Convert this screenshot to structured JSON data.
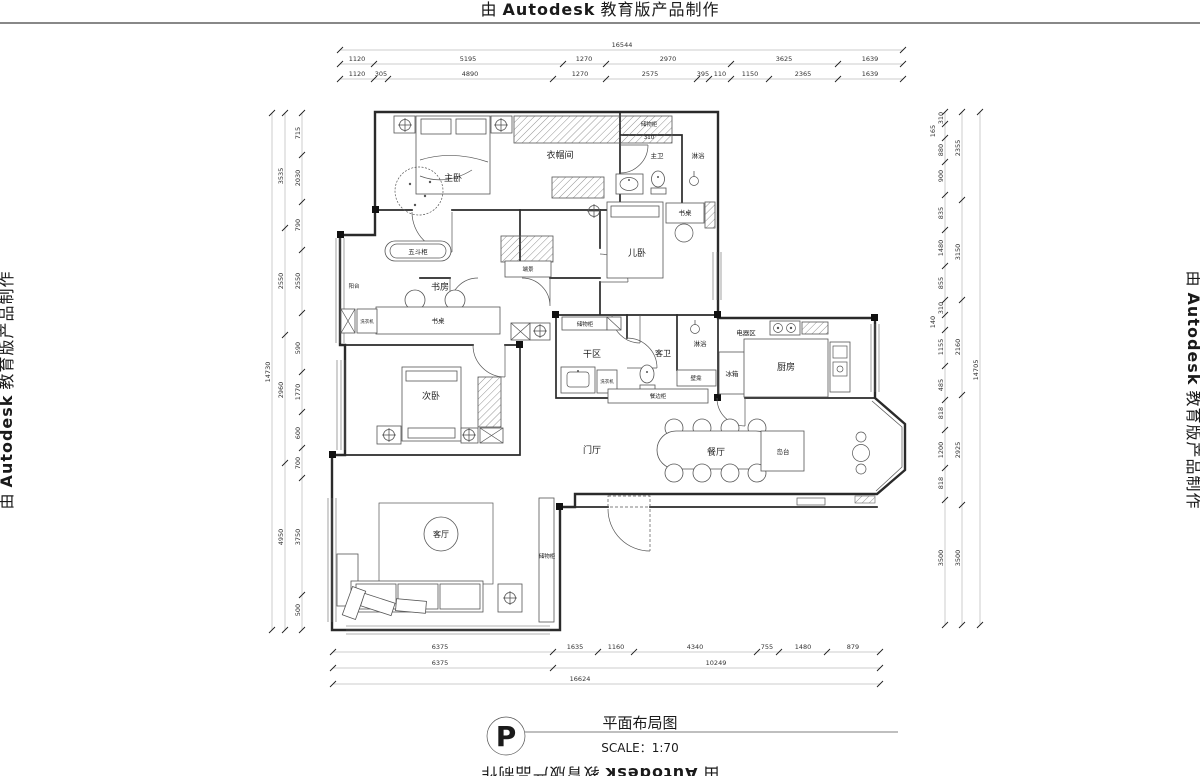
{
  "watermark": {
    "prefix": "由",
    "brand": "Autodesk",
    "suffix": "教育版产品制作"
  },
  "title_block": {
    "north_symbol": "P",
    "title": "平面布局图",
    "scale": "SCALE：1:70"
  },
  "rooms": {
    "master_bedroom": "主卧",
    "cloakroom": "衣帽间",
    "closet_top": "储物柜",
    "closet_top_dim": "310",
    "master_bath": "主卫",
    "master_shower": "淋浴",
    "kids_desk": "书桌",
    "kids_bedroom": "儿卧",
    "chest": "五斗柜",
    "balcony": "阳台",
    "study": "书房",
    "study_desk": "书桌",
    "washer_balcony": "洗衣机",
    "end_feature": "端景",
    "second_bedroom": "次卧",
    "dry_storage": "储物柜",
    "dry_area": "干区",
    "washer": "洗衣机",
    "guest_bath": "客卫",
    "guest_shower": "淋浴",
    "niche": "壁龛",
    "sideboard": "餐边柜",
    "appliance_area": "电器区",
    "fridge": "冰箱",
    "kitchen": "厨房",
    "foyer": "门厅",
    "dining": "餐厅",
    "island": "岛台",
    "living": "客厅",
    "living_storage": "储物柜"
  },
  "dims": {
    "top": {
      "total": "16544",
      "row2": [
        "1120",
        "5195",
        "1270",
        "2970",
        "3625",
        "1639"
      ],
      "row3": [
        "1120",
        "305",
        "4890",
        "1270",
        "2575",
        "395",
        "110",
        "1150",
        "2365",
        "1639"
      ]
    },
    "bottom": {
      "row1": [
        "6375",
        "1635",
        "1160",
        "4340",
        "755",
        "1480",
        "879"
      ],
      "row2": [
        "6375",
        "10249"
      ],
      "total": "16624"
    },
    "left": {
      "outer": "14730",
      "colA": [
        "3535",
        "2550",
        "2960",
        "4950"
      ],
      "colB": [
        "715",
        "2030",
        "790",
        "2550",
        "590",
        "1770",
        "600",
        "700",
        "3750",
        "500"
      ]
    },
    "right": {
      "outer": "14705",
      "colA": [
        "310",
        "165",
        "880",
        "900",
        "835",
        "1480",
        "855",
        "310",
        "140",
        "1155",
        "485",
        "818",
        "1200",
        "818",
        "3500"
      ],
      "colB": [
        "2355",
        "3150",
        "2160",
        "2925",
        "3500"
      ]
    }
  }
}
